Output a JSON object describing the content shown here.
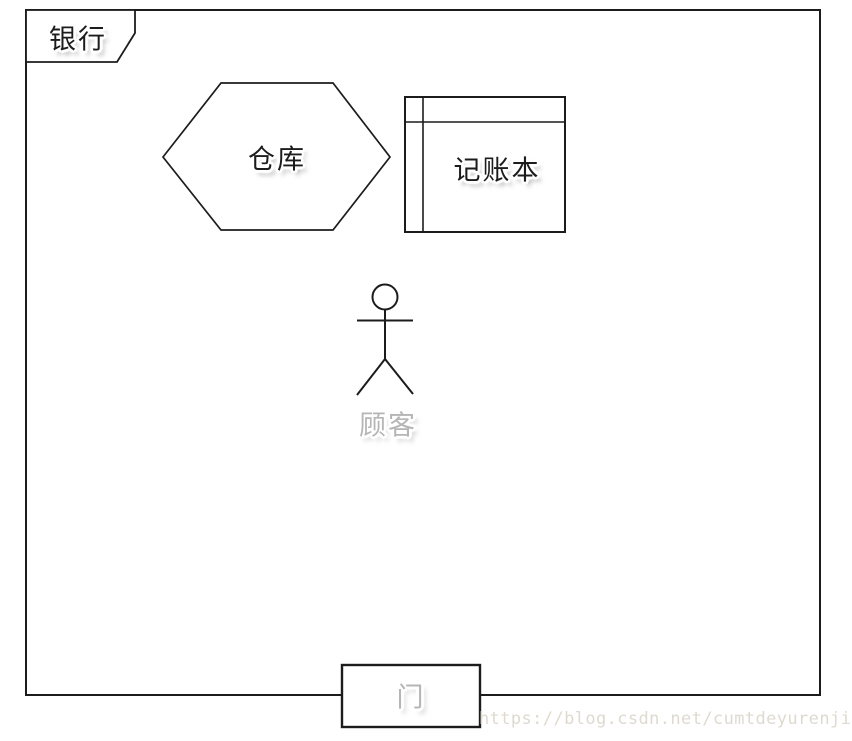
{
  "diagram": {
    "title_tab": {
      "label": "银行"
    },
    "warehouse": {
      "label": "仓库",
      "shape": "hexagon"
    },
    "ledger": {
      "label": "记账本",
      "shape": "ruled-rectangle"
    },
    "customer": {
      "label": "顾客",
      "shape": "stick-figure"
    },
    "door": {
      "label": "门",
      "shape": "rectangle"
    },
    "watermark": {
      "text": "https://blog.csdn.net/cumtdeyurenjie"
    },
    "colors": {
      "stroke": "#1c1c1c",
      "label_text": "#1c1c1c",
      "muted_label_text": "#b5b5b5",
      "watermark_text": "#dedad0",
      "background": "#ffffff"
    }
  }
}
